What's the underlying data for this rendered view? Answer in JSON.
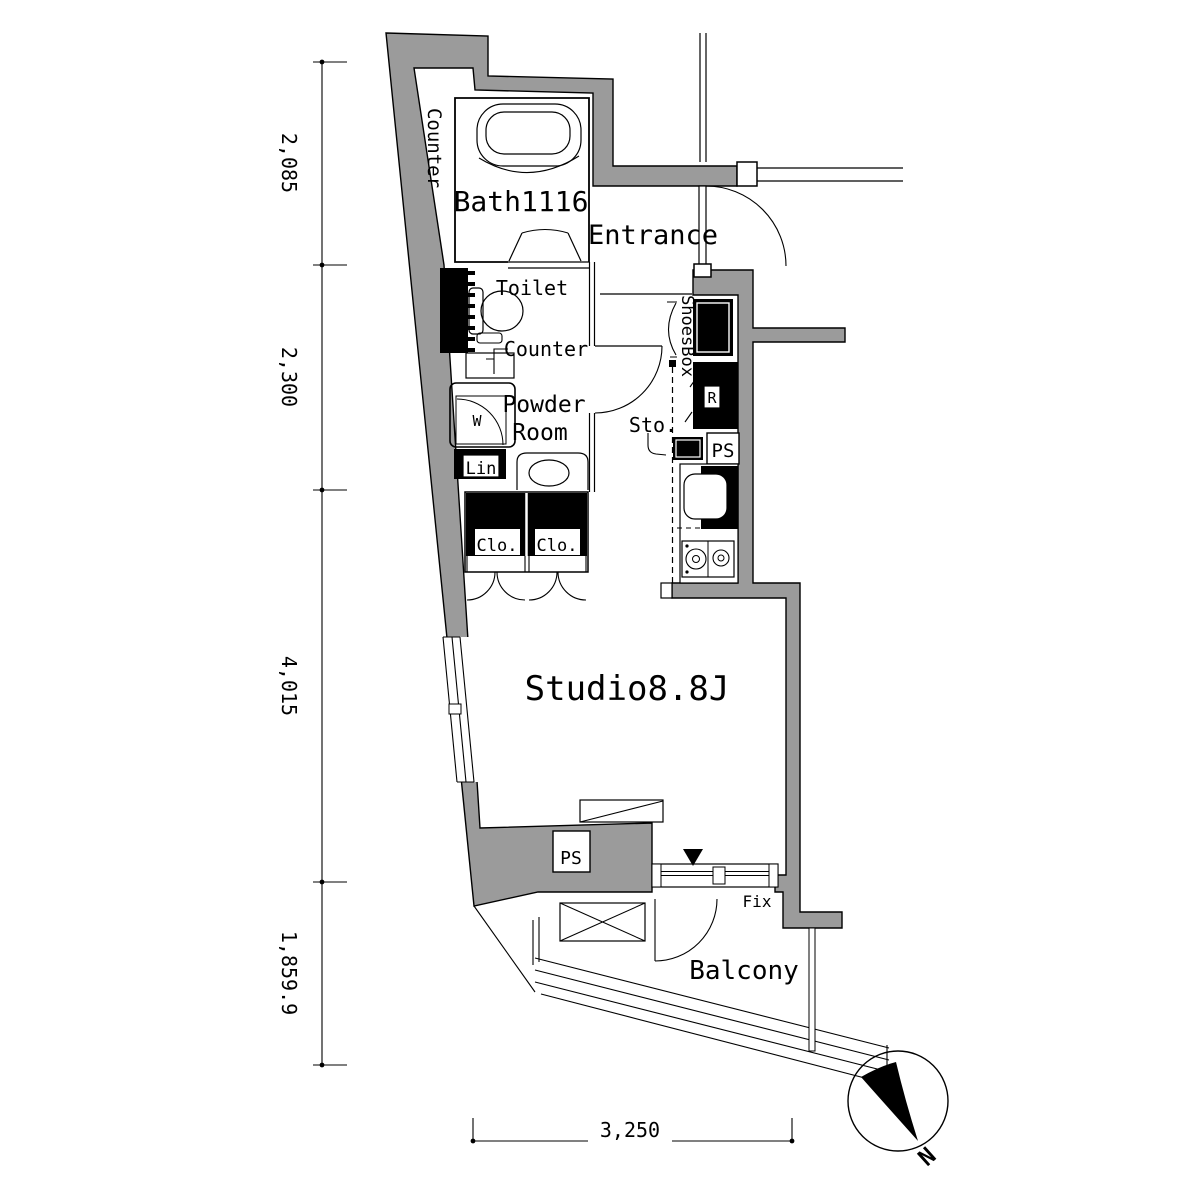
{
  "plan": {
    "rooms": {
      "bath": "Bath1116",
      "entrance": "Entrance",
      "toilet": "Toilet",
      "toilet_counter": "Counter",
      "powder_line1": "Powder",
      "powder_line2": "Room",
      "studio": "Studio8.8J",
      "balcony": "Balcony"
    },
    "fixtures": {
      "counter_left": "Counter",
      "shoesbox": "ShoesBox",
      "storage": "Sto.",
      "refrigerator": "R",
      "ps_kitchen": "PS",
      "ps_studio": "PS",
      "washer": "W",
      "linen": "Lin",
      "closet_left": "Clo.",
      "closet_right": "Clo.",
      "fix_window": "Fix"
    },
    "dimensions": {
      "left": [
        "2,085",
        "2,300",
        "4,015",
        "1,859.9"
      ],
      "bottom": "3,250"
    },
    "compass": {
      "north": "N"
    },
    "colors": {
      "wall": "#9b9b9b",
      "line": "#000000",
      "background": "#ffffff"
    }
  }
}
